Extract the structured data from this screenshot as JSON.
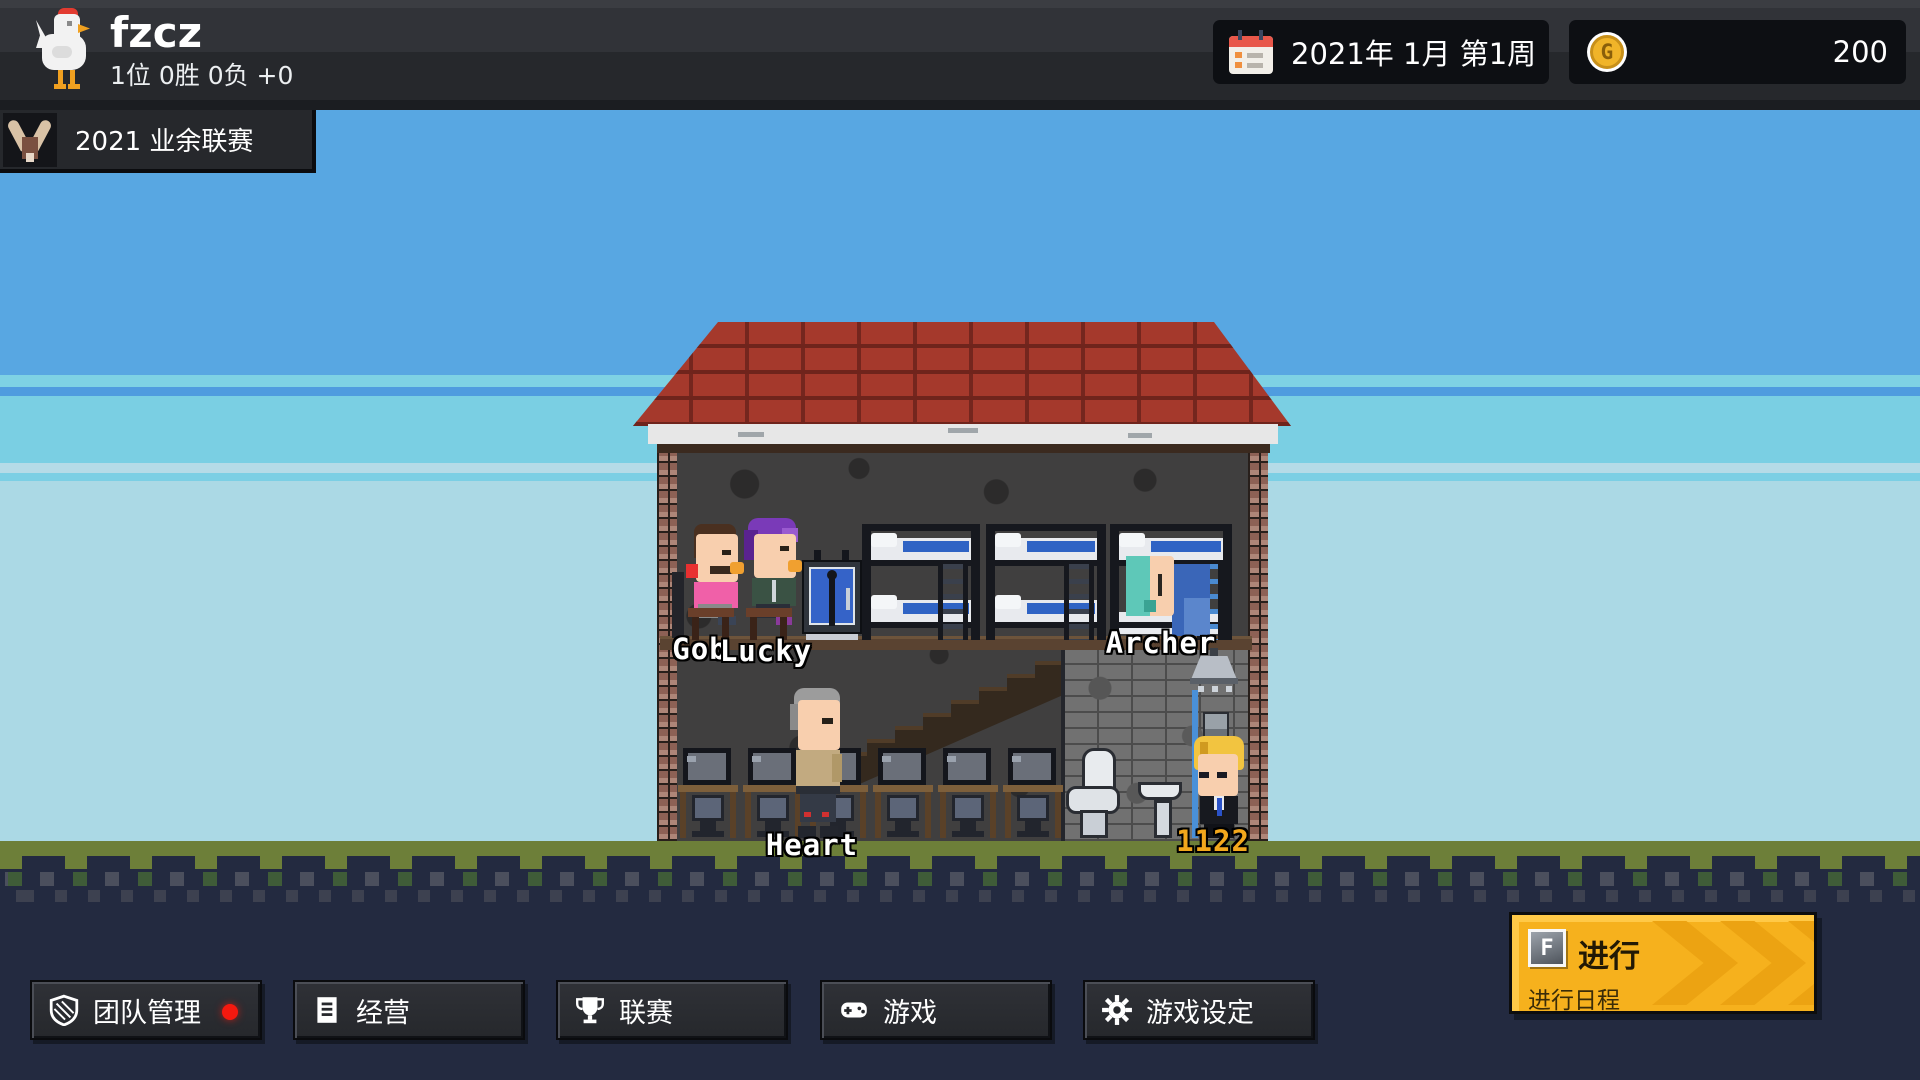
{
  "header": {
    "team_name": "fzcz",
    "team_record": "1位 0胜 0负 +0",
    "date": "2021年 1月 第1周",
    "money": "200",
    "league": "2021 业余联赛",
    "logo_icon": "chicken-icon",
    "date_icon": "calendar-icon",
    "money_icon": "gold-coin-icon",
    "league_icon": "antler-trophy-icon",
    "coin_letter": "G"
  },
  "scene": {
    "building": "team-house",
    "labels": {
      "gob": "Gob",
      "lucky": "Lucky",
      "archer": "Archer",
      "heart": "Heart",
      "shower_player": "1122"
    }
  },
  "toolbar": {
    "buttons": [
      {
        "label": "团队管理",
        "icon": "shield-icon",
        "notification": true
      },
      {
        "label": "经营",
        "icon": "document-icon",
        "notification": false
      },
      {
        "label": "联赛",
        "icon": "trophy-icon",
        "notification": false
      },
      {
        "label": "游戏",
        "icon": "gamepad-icon",
        "notification": false
      },
      {
        "label": "游戏设定",
        "icon": "gear-icon",
        "notification": false
      }
    ],
    "cta": {
      "hotkey": "F",
      "label": "进行",
      "sublabel": "进行日程",
      "color": "#f6b11d"
    }
  },
  "colors": {
    "sky_blue": "#58a7e2",
    "sky_cyan": "#7acfe3",
    "sky_pale": "#abd9e5",
    "grass": "#6d7f39",
    "ground_navy": "#232a40",
    "cta_yellow": "#f6b11d",
    "notification_red": "#f5190f",
    "coin_gold": "#f0b429",
    "label_gold": "#f2a71c",
    "roof_red": "#a5392c"
  }
}
